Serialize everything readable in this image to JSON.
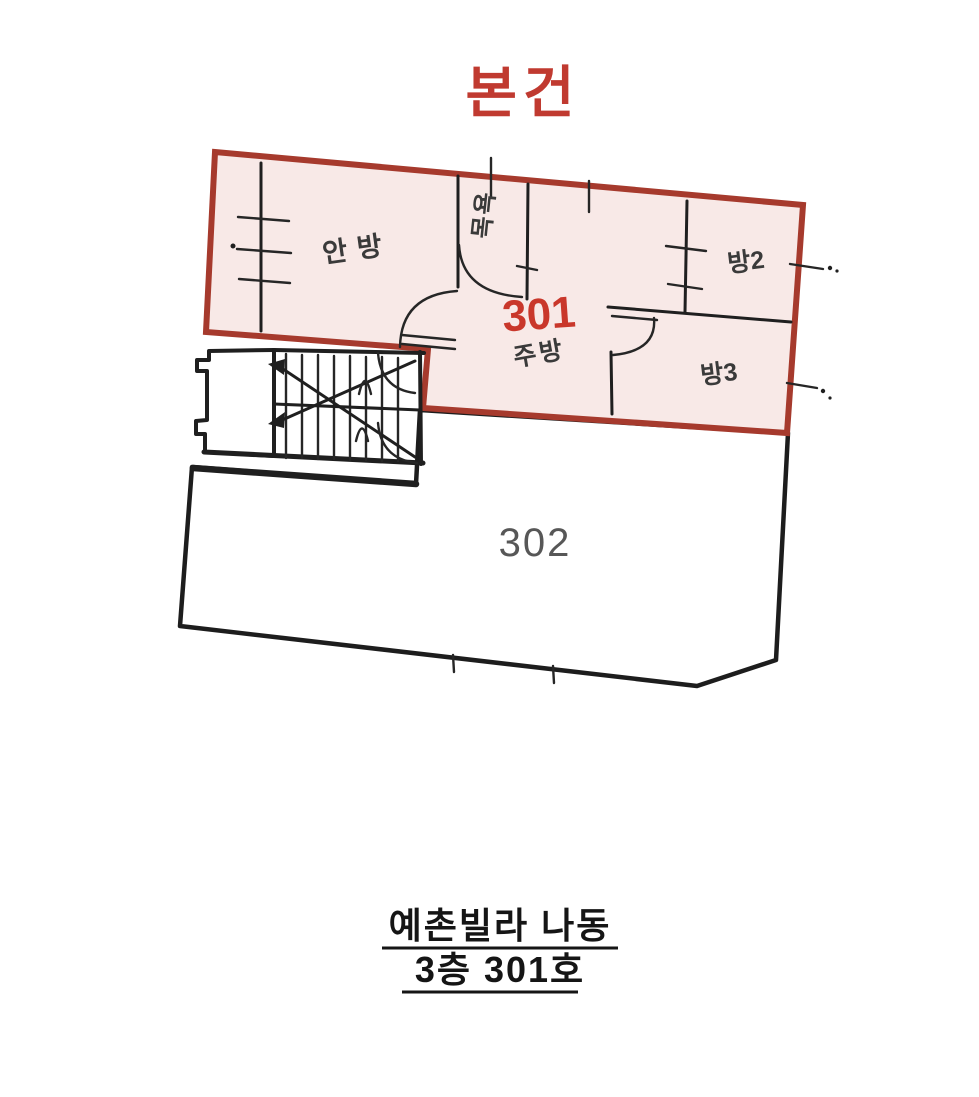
{
  "annotation": {
    "title": "본건",
    "title_color": "#c03a30"
  },
  "units": {
    "unit301": {
      "number": "301",
      "number_color": "#c9372b",
      "outline_color": "#a63a2d",
      "fill_color": "#f8e9e7",
      "rooms": {
        "master_bedroom": "안방",
        "bath": "목욕",
        "kitchen": "주방",
        "room2": "방2",
        "room3": "방3"
      }
    },
    "unit302": {
      "number": "302",
      "number_color": "#575757"
    }
  },
  "stairwell": {
    "description": "common staircase"
  },
  "caption": {
    "line1": "예촌빌라 나동",
    "line2": "3층 301호"
  }
}
